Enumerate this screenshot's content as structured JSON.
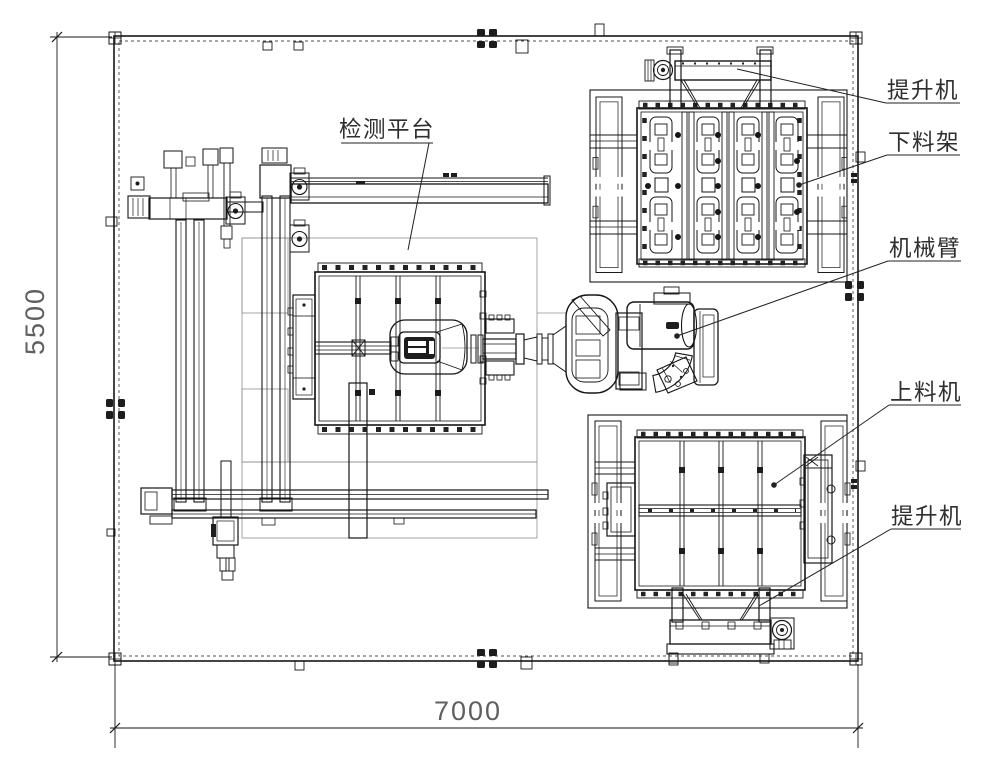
{
  "drawing": {
    "type": "cad-plan-layout",
    "dimensions": {
      "height_label": "5500",
      "width_label": "7000"
    },
    "callouts": {
      "inspection_platform": "检测平台",
      "top_hoist": "提升机",
      "unload_rack": "下料架",
      "robot_arm": "机械臂",
      "load_machine": "上料机",
      "bottom_hoist": "提升机"
    },
    "colors": {
      "background": "#ffffff",
      "line": "#161616",
      "thin_line": "#8f8f8f",
      "dimension_text": "#5f5f5f",
      "label_text": "#2e2e2e"
    }
  }
}
